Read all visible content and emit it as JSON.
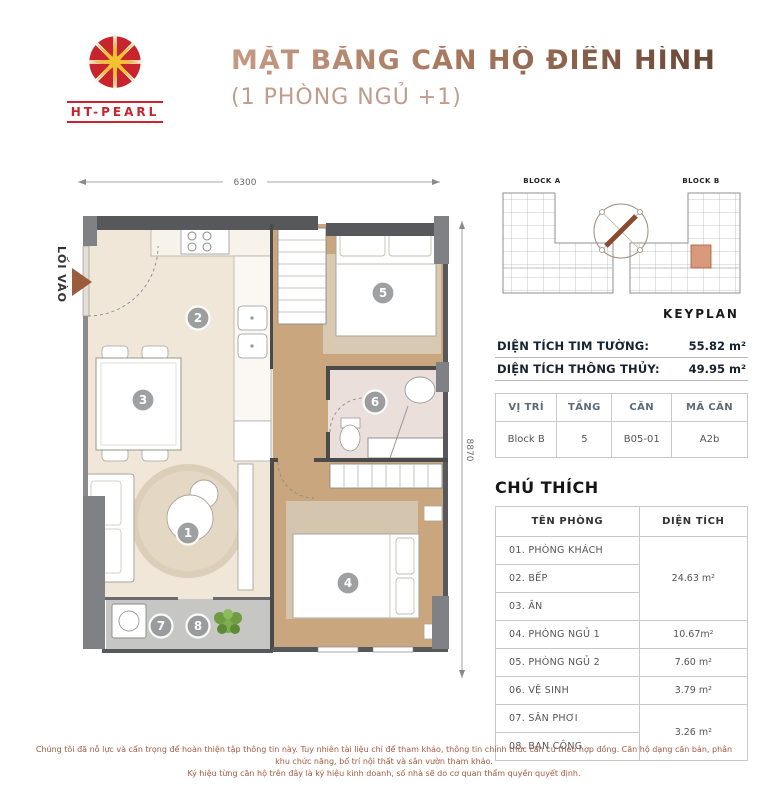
{
  "header": {
    "logo_text": "HT-PEARL",
    "title": "MẶT BẰNG CĂN HỘ ĐIỂN HÌNH",
    "subtitle": "(1 PHÒNG NGỦ +1)"
  },
  "plan": {
    "entry_label": "LỐI VÀO",
    "width_dim": "6300",
    "height_dim": "8870",
    "rooms": {
      "r1": "1",
      "r2": "2",
      "r3": "3",
      "r4": "4",
      "r5": "5",
      "r6": "6",
      "r7": "7",
      "r8": "8"
    }
  },
  "keyplan": {
    "block_a": "BLOCK A",
    "block_b": "BLOCK B",
    "label": "KEYPLAN"
  },
  "area_info": {
    "tim_tuong_label": "DIỆN TÍCH TIM TƯỜNG:",
    "tim_tuong_value": "55.82 m²",
    "thong_thuy_label": "DIỆN TÍCH THÔNG THỦY:",
    "thong_thuy_value": "49.95 m²"
  },
  "unit_table": {
    "headers": [
      "VỊ TRÍ",
      "TẦNG",
      "CĂN",
      "MÃ CĂN"
    ],
    "row": [
      "Block B",
      "5",
      "B05-01",
      "A2b"
    ]
  },
  "legend": {
    "title": "CHÚ THÍCH",
    "col_room": "TÊN PHÒNG",
    "col_area": "DIỆN TÍCH",
    "rows": {
      "r1": "01. PHÒNG KHÁCH",
      "r2": "02. BẾP",
      "r3": "03. ĂN",
      "r4": "04. PHÒNG NGỦ 1",
      "r5": "05. PHÒNG NGỦ 2",
      "r6": "06. VỆ SINH",
      "r7": "07. SÂN PHƠI",
      "r8": "08. BAN CÔNG"
    },
    "areas": {
      "group_living": "24.63 m²",
      "bedroom1": "10.67m²",
      "bedroom2": "7.60 m²",
      "bathroom": "3.79 m²",
      "group_balcony": "3.26 m²"
    }
  },
  "footer": {
    "line1": "Chúng tôi đã nỗ lực và cẩn trọng để hoàn thiện tập thông tin này. Tuy nhiên tài liệu chỉ để tham khảo, thông tin chính thức căn cứ theo hợp đồng. Căn hộ dạng căn bản, phân khu chức năng, bố trí nội thất và sân vườn tham khảo.",
    "line2": "Ký hiệu từng căn hộ trên đây là ký hiệu kinh doanh, số nhà sẽ do cơ quan thẩm quyền quyết định."
  },
  "colors": {
    "accent_red": "#C8242E",
    "title_dark": "#6B4533",
    "title_light": "#C49A83",
    "subtitle": "#C29C8B",
    "text_navy": "#16222E",
    "wall": "#57585C",
    "wood_floor": "#C9A67E",
    "beige_floor": "#F0E7D9",
    "tile_floor": "#C6C6C3",
    "bath_floor": "#EADFDA",
    "unit_highlight": "#D89A7B",
    "footer_text": "#A3593F"
  }
}
